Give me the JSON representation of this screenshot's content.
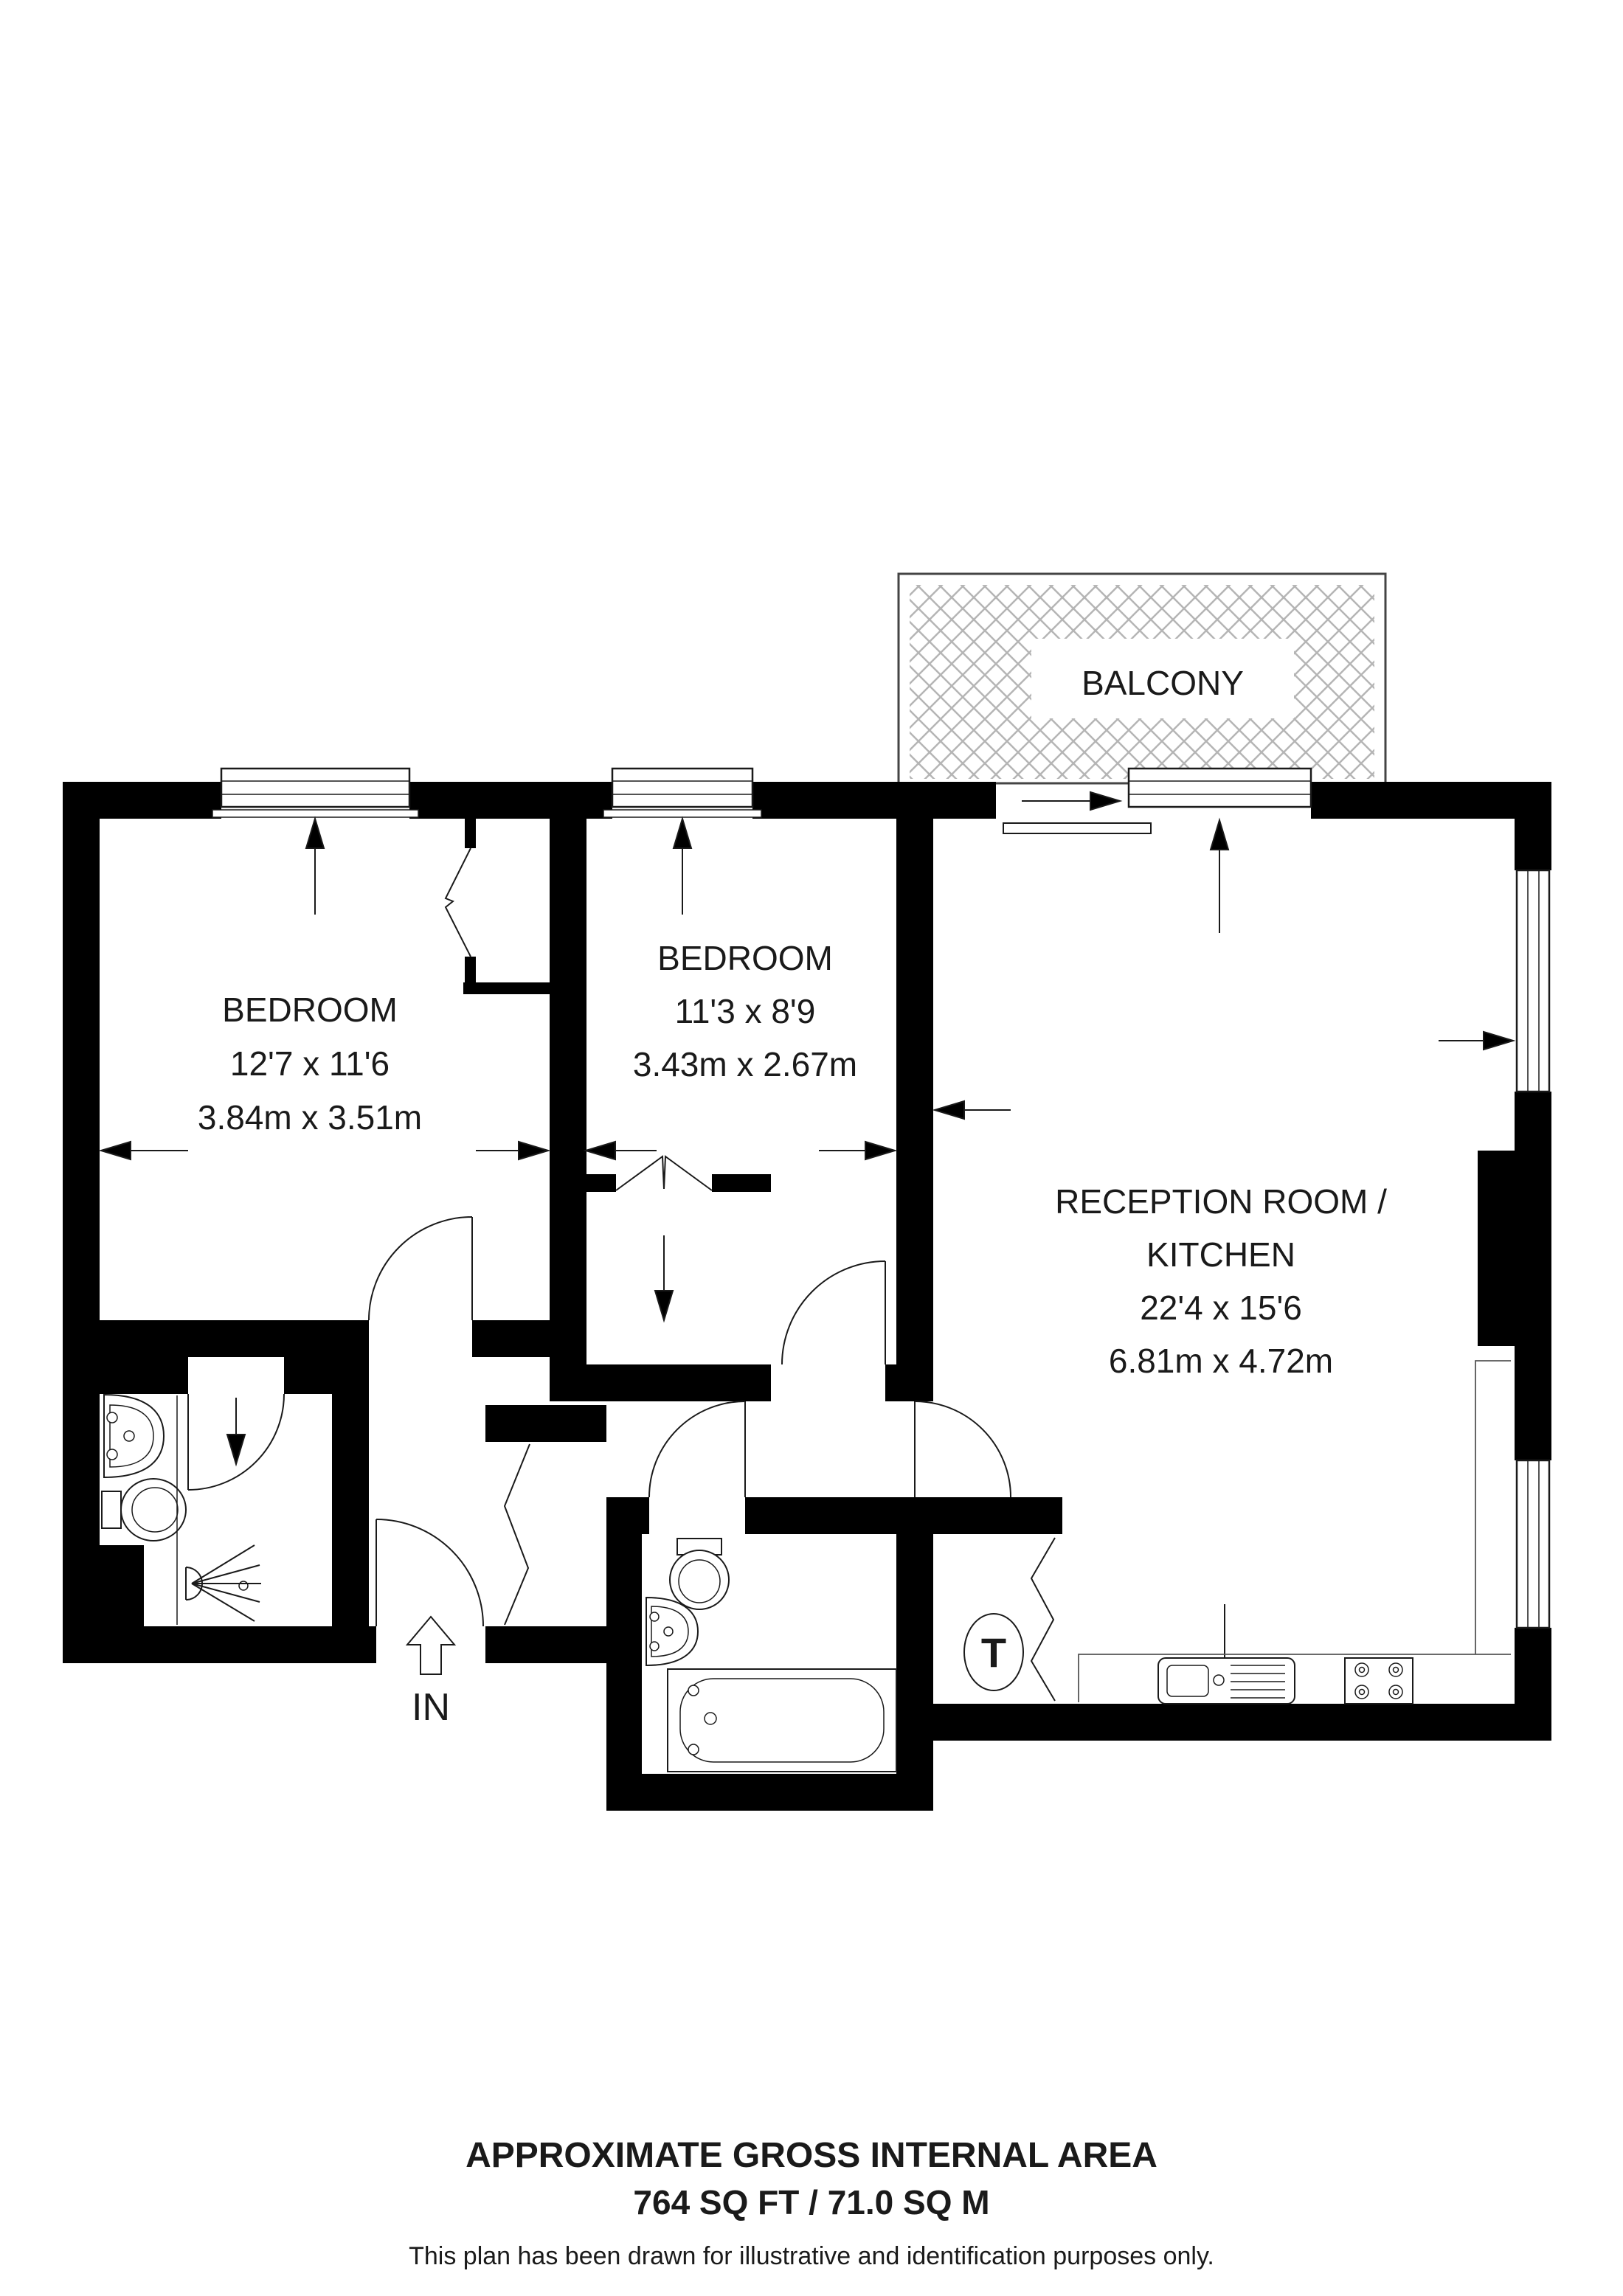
{
  "plan": {
    "balcony_label": "BALCONY",
    "entrance_label": "IN",
    "tank_label": "T",
    "rooms": [
      {
        "name": "BEDROOM",
        "imperial": "12'7 x 11'6",
        "metric": "3.84m x 3.51m"
      },
      {
        "name": "BEDROOM",
        "imperial": "11'3 x 8'9",
        "metric": "3.43m x 2.67m"
      },
      {
        "name_line1": "RECEPTION ROOM /",
        "name_line2": "KITCHEN",
        "imperial": "22'4 x 15'6",
        "metric": "6.81m x 4.72m"
      }
    ]
  },
  "footer": {
    "title": "APPROXIMATE GROSS INTERNAL AREA",
    "area": "764 SQ FT / 71.0 SQ M",
    "disclaimer": "This plan has been drawn for illustrative and identification purposes only."
  },
  "colors": {
    "wall": "#000000",
    "hatch": "#b5b5b5",
    "line": "#1a1a1a"
  }
}
